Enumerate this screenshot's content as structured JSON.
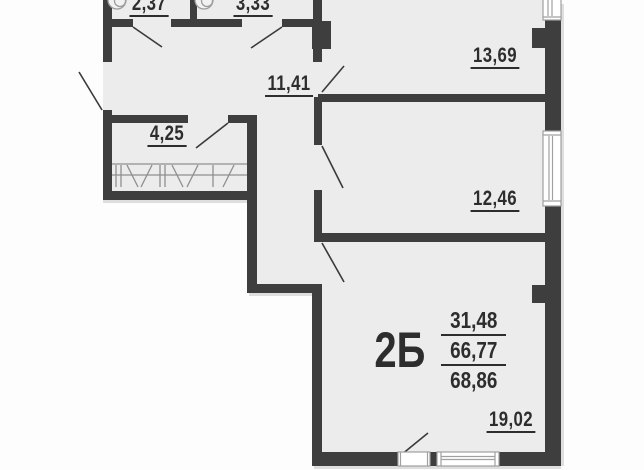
{
  "floor_plan": {
    "apartment": {
      "type_label": "2Б",
      "living_area": "31,48",
      "area_without_balcony": "66,77",
      "total_area": "68,86"
    },
    "rooms": [
      {
        "name": "wc-top-left",
        "area": "2,37"
      },
      {
        "name": "bathroom-top",
        "area": "3,33"
      },
      {
        "name": "room-top-right",
        "area": "13,69"
      },
      {
        "name": "hallway",
        "area": "11,41"
      },
      {
        "name": "wardrobe",
        "area": "4,25"
      },
      {
        "name": "room-middle-right",
        "area": "12,46"
      },
      {
        "name": "living-room-bottom",
        "area": "19,02"
      }
    ],
    "colors": {
      "wall": "#3e3e3e",
      "floor": "#ececec",
      "outside": "#fdfdfd",
      "door_line": "#3a3a3a",
      "hatch": "#8f8f8f",
      "window_frame": "#a0a0a0",
      "text": "#2d2d2d"
    }
  }
}
